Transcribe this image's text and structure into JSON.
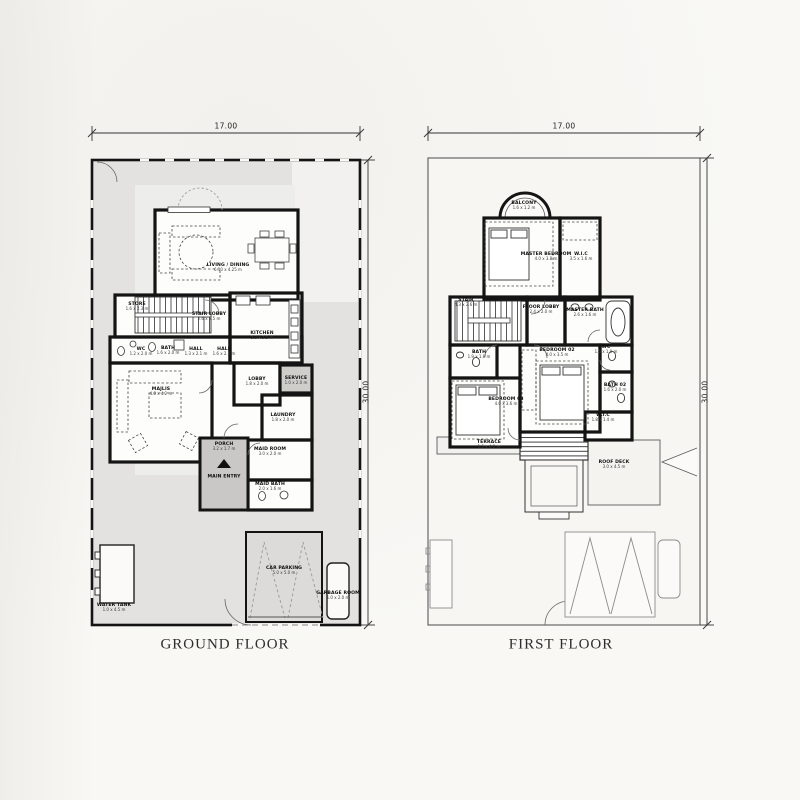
{
  "titles": {
    "ground": "GROUND FLOOR",
    "first": "FIRST FLOOR"
  },
  "dims": {
    "ground_top": "17.00",
    "ground_side": "30.00",
    "first_top": "17.00",
    "first_side": "30.00"
  },
  "colors": {
    "paper": "#f9f8f5",
    "plot_fill": "#e3e2e0",
    "plot_inner_fill": "#ededeb",
    "porch_fill": "#c9c8c6",
    "wall": "#141414",
    "thin_line": "#555555"
  },
  "ground_labels": [
    {
      "name": "LIVING / DINING",
      "dims": "6.10 x 4.25 m",
      "x": 228,
      "y": 268
    },
    {
      "name": "STORE",
      "dims": "1.6 x 2.3 m",
      "x": 137,
      "y": 307
    },
    {
      "name": "STAIR LOBBY",
      "dims": "2.6 x 2.5 m",
      "x": 209,
      "y": 317
    },
    {
      "name": "KITCHEN",
      "dims": "3.2 x 3.5 m",
      "x": 262,
      "y": 336
    },
    {
      "name": "WC",
      "dims": "1.2 x 2.0 m",
      "x": 141,
      "y": 352
    },
    {
      "name": "BATH",
      "dims": "1.6 x 2.0 m",
      "x": 168,
      "y": 351
    },
    {
      "name": "HALL",
      "dims": "1.3 x 2.1 m",
      "x": 196,
      "y": 352
    },
    {
      "name": "HALL",
      "dims": "1.6 x 2.1 m",
      "x": 224,
      "y": 352
    },
    {
      "name": "MAJLIS",
      "dims": "4.8 x 4.2 m",
      "x": 161,
      "y": 392
    },
    {
      "name": "LOBBY",
      "dims": "1.8 x 2.0 m",
      "x": 257,
      "y": 382
    },
    {
      "name": "SERVICE",
      "dims": "1.0 x 2.0 m",
      "x": 296,
      "y": 381
    },
    {
      "name": "LAUNDRY",
      "dims": "1.8 x 2.0 m",
      "x": 283,
      "y": 418
    },
    {
      "name": "PORCH",
      "dims": "3.2 x 1.7 m",
      "x": 224,
      "y": 447
    },
    {
      "name": "MAIN ENTRY",
      "x": 224,
      "y": 477
    },
    {
      "name": "MAID ROOM",
      "dims": "3.0 x 2.0 m",
      "x": 270,
      "y": 452
    },
    {
      "name": "MAID BATH",
      "dims": "2.0 x 1.6 m",
      "x": 270,
      "y": 487
    },
    {
      "name": "WATER TANK",
      "dims": "1.0 x 4.5 m",
      "x": 114,
      "y": 608
    },
    {
      "name": "CAR PARKING",
      "dims": "5.0 x 5.0 m",
      "x": 284,
      "y": 571
    },
    {
      "name": "GARBAGE ROOM",
      "dims": "1.0 x 2.0 m",
      "x": 338,
      "y": 596
    }
  ],
  "first_labels": [
    {
      "name": "BALCONY",
      "dims": "1.6 x 1.2 m",
      "x": 524,
      "y": 206
    },
    {
      "name": "MASTER BEDROOM",
      "dims": "4.0 x 3.8 m",
      "x": 546,
      "y": 257
    },
    {
      "name": "W.I.C",
      "dims": "3.5 x 1.6 m",
      "x": 581,
      "y": 257
    },
    {
      "name": "STAIR",
      "dims": "4.3 x 2.6 m",
      "x": 466,
      "y": 303
    },
    {
      "name": "FLOOR LOBBY",
      "dims": "2.4 x 2.0 m",
      "x": 541,
      "y": 310
    },
    {
      "name": "MASTER BATH",
      "dims": "2.6 x 1.6 m",
      "x": 585,
      "y": 313
    },
    {
      "name": "BATH",
      "dims": "1.9 x 1.8 m",
      "x": 479,
      "y": 355
    },
    {
      "name": "BEDROOM 02",
      "dims": "4.0 x 3.5 m",
      "x": 557,
      "y": 353
    },
    {
      "name": "WC",
      "dims": "1.5 x 1.0 m",
      "x": 606,
      "y": 350
    },
    {
      "name": "BATH 02",
      "dims": "1.6 x 2.0 m",
      "x": 615,
      "y": 388
    },
    {
      "name": "W.I.C",
      "dims": "1.8 x 1.4 m",
      "x": 603,
      "y": 418
    },
    {
      "name": "BEDROOM 03",
      "dims": "4.0 x 3.6 m",
      "x": 506,
      "y": 402
    },
    {
      "name": "TERRACE",
      "dims": "1.5 x 4.0 m",
      "x": 489,
      "y": 445
    },
    {
      "name": "ROOF DECK",
      "dims": "3.0 x 4.5 m",
      "x": 614,
      "y": 465
    }
  ]
}
